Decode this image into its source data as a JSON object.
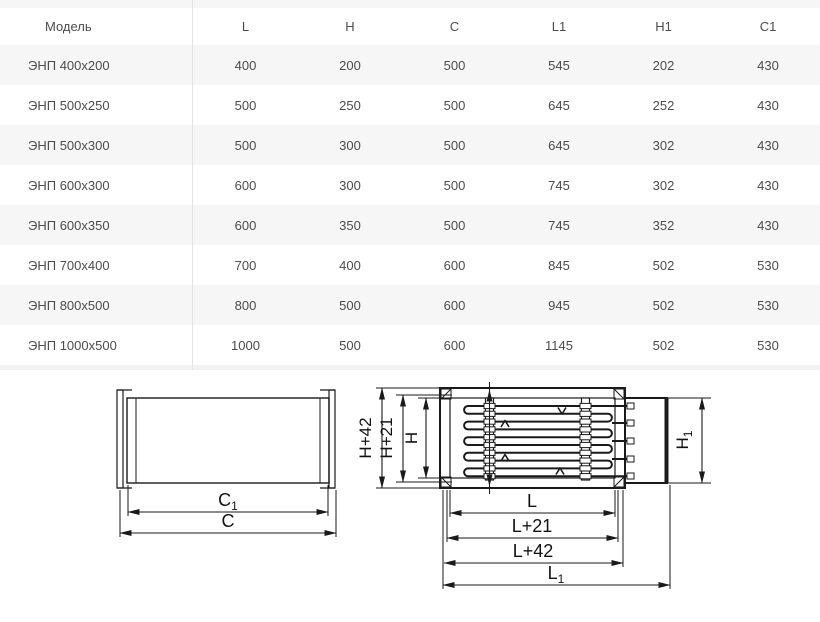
{
  "table": {
    "columns": [
      "Модель",
      "L",
      "H",
      "C",
      "L1",
      "H1",
      "C1"
    ],
    "rows": [
      [
        "ЭНП 400x200",
        "400",
        "200",
        "500",
        "545",
        "202",
        "430"
      ],
      [
        "ЭНП 500x250",
        "500",
        "250",
        "500",
        "645",
        "252",
        "430"
      ],
      [
        "ЭНП 500x300",
        "500",
        "300",
        "500",
        "645",
        "302",
        "430"
      ],
      [
        "ЭНП 600x300",
        "600",
        "300",
        "500",
        "745",
        "302",
        "430"
      ],
      [
        "ЭНП 600x350",
        "600",
        "350",
        "500",
        "745",
        "352",
        "430"
      ],
      [
        "ЭНП 700x400",
        "700",
        "400",
        "600",
        "845",
        "502",
        "530"
      ],
      [
        "ЭНП 800x500",
        "800",
        "500",
        "600",
        "945",
        "502",
        "530"
      ],
      [
        "ЭНП 1000x500",
        "1000",
        "500",
        "600",
        "1145",
        "502",
        "530"
      ]
    ],
    "colors": {
      "stripe": "#f6f6f7",
      "text": "#4c4c4c",
      "divider": "#e3e3e3"
    }
  },
  "diagram": {
    "line_color": "#1a1a1a",
    "side_view": {
      "labels": {
        "c1": {
          "base": "C",
          "sub": "1"
        },
        "c": "C"
      }
    },
    "top_view": {
      "labels": {
        "h42": "H+42",
        "h21": "H+21",
        "h": "H",
        "h1": {
          "base": "H",
          "sub": "1"
        },
        "l": "L",
        "l21": "L+21",
        "l42": "L+42",
        "l1": {
          "base": "L",
          "sub": "1"
        }
      }
    }
  }
}
